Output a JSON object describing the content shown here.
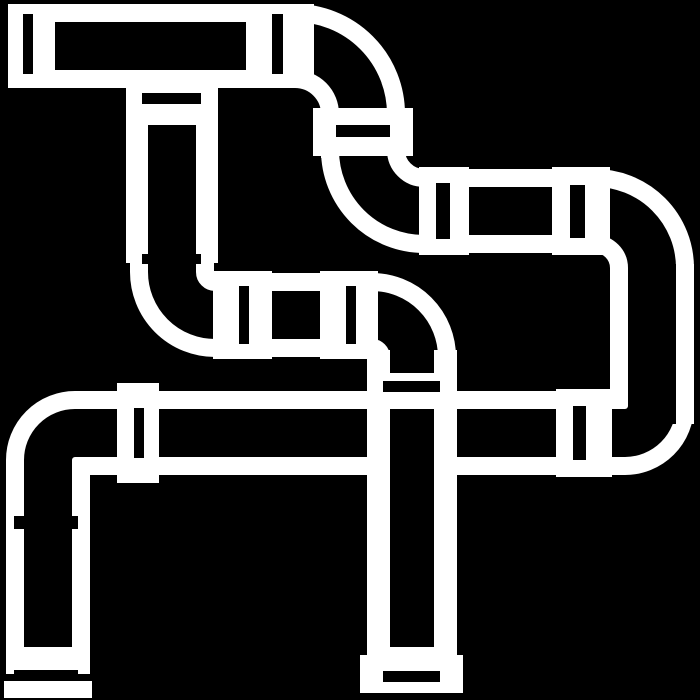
{
  "icon": {
    "name": "pipes-icon",
    "description": "White outline icon of an industrial pipe network with flanged joints, 90-degree elbows, a tee junction and end caps, drawn on a black background",
    "foreground": "#ffffff",
    "background": "#000000"
  },
  "canvas": {
    "width": "700",
    "height": "700"
  }
}
